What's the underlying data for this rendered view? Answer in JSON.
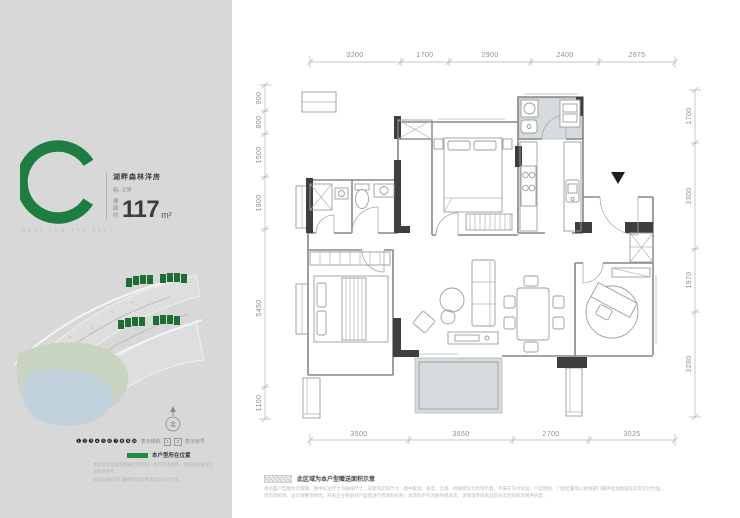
{
  "unit": {
    "letter": "C",
    "name": "湖畔森林洋房",
    "type": "标-3房",
    "area_prefix": "建面约",
    "area_value": "117",
    "area_unit": "m²",
    "tagline": "BEST FOR THE BEST"
  },
  "compass": {
    "north": "北"
  },
  "sidebar": {
    "legend_buildings_icons": "❶❷❸❹❺❻❼❽❾❿",
    "legend_buildings_label": "表示楼栋",
    "legend_room_1": "1",
    "legend_room_2": "2",
    "legend_rooms_label": "表示房号",
    "location_label": "本户型所在位置",
    "disclaimer_line1": "本区位示意图非精确比例绘制，项目周边道路、景观及配套等信息仅供参考，",
    "disclaimer_line2": "具体以政府部门最终批准文件及实际交付为准。"
  },
  "plan": {
    "dims_top": [
      "3200",
      "1700",
      "2900",
      "2400",
      "2675"
    ],
    "dims_bottom": [
      "3500",
      "3650",
      "2700",
      "3025"
    ],
    "dims_left": [
      "900",
      "800",
      "1500",
      "1800",
      "5450",
      "1100"
    ],
    "dims_right": [
      "1700",
      "3300",
      "1970",
      "3280"
    ]
  },
  "footnote": {
    "area_label": "此区域为本户型赠送面积示意",
    "line1": "本页面户型图为示意图，图中标注尺寸为轴线尺寸，非套内实际尺寸；图中家具、家电、洁具、绿植等仅为装饰示意，不属于交付标准；户型结构、门窗位置等以规划部门最终批准图纸及实际交付为准。",
    "line2": "因市政规划、设计调整等原因，开发企业保留对户型图进行修改的权利；本资料不作为要约或承诺，详情请参阅商品房买卖合同及其附件约定。"
  },
  "colors": {
    "brand_green": "#1e7d41",
    "map_building_green": "#1d6e35",
    "balcony_shade": "#d6dcde",
    "panel_gray": "#d8d8d8"
  }
}
